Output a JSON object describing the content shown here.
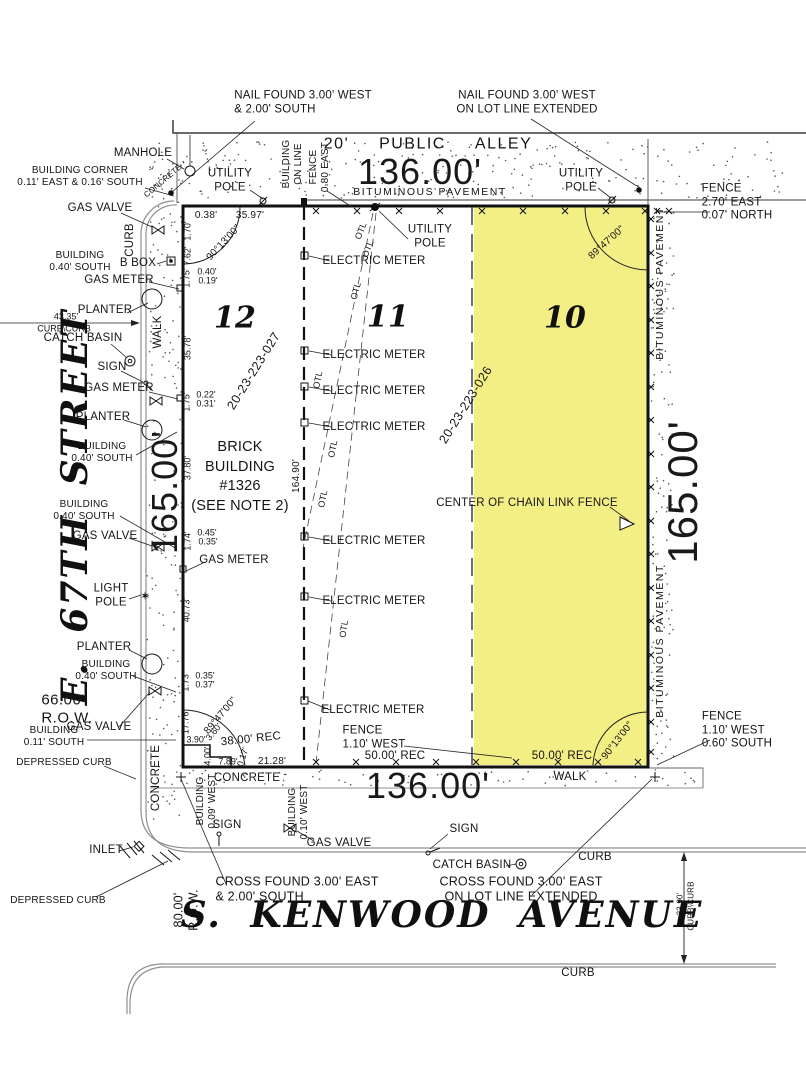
{
  "drawing_type": "plat-of-survey",
  "colors": {
    "highlight": "#f2ee7b",
    "linework": "#1c1c1c",
    "curb": "#8f8f8f"
  },
  "lots": [
    {
      "number": "12",
      "pin": "20-23-223-027"
    },
    {
      "number": "11",
      "pin": "20-23-223-026"
    },
    {
      "number": "10",
      "highlighted": true
    }
  ],
  "labels": [
    {
      "name": "nail-found-nw",
      "text": "NAIL FOUND 3.00' WEST\n& 2.00' SOUTH",
      "x": 303,
      "y": 103,
      "rot": 0,
      "cls": "t12 al"
    },
    {
      "name": "nail-found-ne",
      "text": "NAIL FOUND 3.00' WEST\nON LOT LINE EXTENDED",
      "x": 527,
      "y": 103,
      "rot": 0,
      "cls": "t12"
    },
    {
      "name": "manhole-label",
      "text": "MANHOLE",
      "x": 143,
      "y": 154,
      "rot": 0,
      "cls": "t12"
    },
    {
      "name": "building-corner-label",
      "text": "BUILDING CORNER\n0.11' EAST & 0.16' SOUTH",
      "x": 80,
      "y": 177,
      "rot": 0,
      "cls": "t10"
    },
    {
      "name": "concrete-corner-label",
      "text": "CONCRETE",
      "x": 163,
      "y": 181,
      "rot": -40,
      "cls": "t8"
    },
    {
      "name": "utility-pole-label-1",
      "text": "UTILITY\nPOLE",
      "x": 230,
      "y": 181,
      "rot": 0,
      "cls": "t12"
    },
    {
      "name": "building-on-line-label",
      "text": "BUILDING\nON LINE",
      "x": 293,
      "y": 164,
      "rot": -90,
      "cls": "t10"
    },
    {
      "name": "fence-080-label",
      "text": "FENCE\n0.80 EAST",
      "x": 320,
      "y": 167,
      "rot": -90,
      "cls": "t10"
    },
    {
      "name": "alley-label",
      "text": "20' PUBLIC ALLEY",
      "x": 428,
      "y": 145,
      "rot": 0,
      "cls": "alley"
    },
    {
      "name": "dim-136-top",
      "text": "136.00'",
      "x": 420,
      "y": 172,
      "rot": 0,
      "cls": "big"
    },
    {
      "name": "bituminous-alley-label",
      "text": "BITUMINOUS PAVEMENT",
      "x": 430,
      "y": 192,
      "rot": 0,
      "cls": "bit"
    },
    {
      "name": "utility-pole-label-2",
      "text": "UTILITY\nPOLE",
      "x": 581,
      "y": 181,
      "rot": 0,
      "cls": "t12"
    },
    {
      "name": "fence-ne-label",
      "text": "FENCE\n2.70' EAST\n0.07' NORTH",
      "x": 737,
      "y": 203,
      "rot": 0,
      "cls": "t12 al"
    },
    {
      "name": "gas-valve-label-1",
      "text": "GAS VALVE",
      "x": 100,
      "y": 209,
      "rot": 0,
      "cls": "t12"
    },
    {
      "name": "curb-left-label",
      "text": "CURB",
      "x": 131,
      "y": 240,
      "rot": -90,
      "cls": "t12"
    },
    {
      "name": "building-040-label-1",
      "text": "BUILDING\n0.40' SOUTH",
      "x": 80,
      "y": 262,
      "rot": 0,
      "cls": "t10"
    },
    {
      "name": "bbox-label",
      "text": "B BOX",
      "x": 138,
      "y": 264,
      "rot": 0,
      "cls": "t12"
    },
    {
      "name": "gas-meter-label-1",
      "text": "GAS METER",
      "x": 119,
      "y": 281,
      "rot": 0,
      "cls": "t12"
    },
    {
      "name": "planter-label-1",
      "text": "PLANTER",
      "x": 105,
      "y": 311,
      "rot": 0,
      "cls": "t12"
    },
    {
      "name": "dim-4335",
      "text": "43.35'",
      "x": 66,
      "y": 317,
      "rot": 0,
      "cls": "t9"
    },
    {
      "name": "curbcurb-label-1",
      "text": "CURB\\CURB",
      "x": 64,
      "y": 329,
      "rot": 0,
      "cls": "t9"
    },
    {
      "name": "catch-basin-label-1",
      "text": "CATCH BASIN",
      "x": 83,
      "y": 339,
      "rot": 0,
      "cls": "t12"
    },
    {
      "name": "sign-label-1",
      "text": "SIGN",
      "x": 112,
      "y": 368,
      "rot": 0,
      "cls": "t12"
    },
    {
      "name": "gas-meter-label-2",
      "text": "GAS METER",
      "x": 119,
      "y": 389,
      "rot": 0,
      "cls": "t12"
    },
    {
      "name": "planter-label-2",
      "text": "PLANTER",
      "x": 103,
      "y": 418,
      "rot": 0,
      "cls": "t12"
    },
    {
      "name": "building-040-label-2",
      "text": "BUILDING\n0.40' SOUTH",
      "x": 102,
      "y": 453,
      "rot": 0,
      "cls": "t10"
    },
    {
      "name": "building-040-label-3",
      "text": "BUILDING\n0.40' SOUTH",
      "x": 84,
      "y": 511,
      "rot": 0,
      "cls": "t10"
    },
    {
      "name": "gas-valve-label-2",
      "text": "GAS VALVE",
      "x": 105,
      "y": 537,
      "rot": 0,
      "cls": "t12"
    },
    {
      "name": "gas-meter-label-3",
      "text": "GAS METER",
      "x": 234,
      "y": 561,
      "rot": 0,
      "cls": "t12"
    },
    {
      "name": "light-pole-label",
      "text": "LIGHT\nPOLE",
      "x": 111,
      "y": 596,
      "rot": 0,
      "cls": "t12"
    },
    {
      "name": "planter-label-3",
      "text": "PLANTER",
      "x": 104,
      "y": 648,
      "rot": 0,
      "cls": "t12"
    },
    {
      "name": "street-67th-label",
      "text": "E. 67TH STREET",
      "x": 75,
      "y": 507,
      "rot": -90,
      "cls": "street"
    },
    {
      "name": "building-040-label-4",
      "text": "BUILDING\n0.40' SOUTH",
      "x": 106,
      "y": 671,
      "rot": 0,
      "cls": "t10"
    },
    {
      "name": "row-66-label",
      "text": "66.00'\nR.O.W.",
      "x": 67,
      "y": 709,
      "rot": 0,
      "cls": "t15 al"
    },
    {
      "name": "gas-valve-label-3",
      "text": "GAS VALVE",
      "x": 99,
      "y": 728,
      "rot": 0,
      "cls": "t12"
    },
    {
      "name": "building-011-label",
      "text": "BUILDING\n0.11' SOUTH",
      "x": 54,
      "y": 737,
      "rot": 0,
      "cls": "t10"
    },
    {
      "name": "depressed-curb-label-1",
      "text": "DEPRESSED CURB",
      "x": 64,
      "y": 763,
      "rot": 0,
      "cls": "t10"
    },
    {
      "name": "concrete-left-label",
      "text": "CONCRETE",
      "x": 157,
      "y": 778,
      "rot": -90,
      "cls": "t12"
    },
    {
      "name": "inlet-label",
      "text": "INLET",
      "x": 106,
      "y": 851,
      "rot": 0,
      "cls": "t12"
    },
    {
      "name": "depressed-curb-label-2",
      "text": "DEPRESSED CURB",
      "x": 58,
      "y": 901,
      "rot": 0,
      "cls": "t10"
    },
    {
      "name": "row-80-label",
      "text": "80.00'\nR.O.W.",
      "x": 186,
      "y": 910,
      "rot": -90,
      "cls": "t13"
    },
    {
      "name": "dim-038",
      "text": "0.38'",
      "x": 206,
      "y": 216,
      "rot": 0,
      "cls": "t10"
    },
    {
      "name": "dim-3597",
      "text": "35.97'",
      "x": 250,
      "y": 216,
      "rot": 0,
      "cls": "t10"
    },
    {
      "name": "dim-170",
      "text": "1.70'",
      "x": 188,
      "y": 231,
      "rot": -90,
      "cls": "t9"
    },
    {
      "name": "dim-762",
      "text": "7.62'",
      "x": 188,
      "y": 256,
      "rot": -90,
      "cls": "t9"
    },
    {
      "name": "angle-nw",
      "text": "90°13'00\"",
      "x": 224,
      "y": 243,
      "rot": -47,
      "cls": "t10"
    },
    {
      "name": "dim-175-a",
      "text": "1.75'",
      "x": 187,
      "y": 278,
      "rot": -90,
      "cls": "t9"
    },
    {
      "name": "dim-040",
      "text": "0.40'",
      "x": 207,
      "y": 272,
      "rot": 0,
      "cls": "t9"
    },
    {
      "name": "dim-019",
      "text": "0.19'",
      "x": 208,
      "y": 281,
      "rot": 0,
      "cls": "t9"
    },
    {
      "name": "dim-3578",
      "text": "35.78'",
      "x": 188,
      "y": 348,
      "rot": -90,
      "cls": "t9"
    },
    {
      "name": "dim-175-b",
      "text": "1.75'",
      "x": 187,
      "y": 402,
      "rot": -90,
      "cls": "t9"
    },
    {
      "name": "dim-022",
      "text": "0.22'",
      "x": 206,
      "y": 395,
      "rot": 0,
      "cls": "t9"
    },
    {
      "name": "dim-031",
      "text": "0.31'",
      "x": 206,
      "y": 404,
      "rot": 0,
      "cls": "t9"
    },
    {
      "name": "dim-3780",
      "text": "37.80'",
      "x": 188,
      "y": 468,
      "rot": -90,
      "cls": "t9"
    },
    {
      "name": "dim-174",
      "text": "1.74'",
      "x": 188,
      "y": 541,
      "rot": -90,
      "cls": "t9"
    },
    {
      "name": "dim-045",
      "text": "0.45'",
      "x": 207,
      "y": 533,
      "rot": 0,
      "cls": "t9"
    },
    {
      "name": "dim-035-a",
      "text": "0.35'",
      "x": 208,
      "y": 542,
      "rot": 0,
      "cls": "t9"
    },
    {
      "name": "dim-4073",
      "text": "40.73'",
      "x": 187,
      "y": 610,
      "rot": -90,
      "cls": "t9"
    },
    {
      "name": "dim-173",
      "text": "1.73'",
      "x": 186,
      "y": 682,
      "rot": -90,
      "cls": "t9"
    },
    {
      "name": "dim-035-b",
      "text": "0.35'",
      "x": 205,
      "y": 676,
      "rot": 0,
      "cls": "t9"
    },
    {
      "name": "dim-037",
      "text": "0.37'",
      "x": 205,
      "y": 685,
      "rot": 0,
      "cls": "t9"
    },
    {
      "name": "dim-1776",
      "text": "17.76'",
      "x": 186,
      "y": 722,
      "rot": -90,
      "cls": "t9"
    },
    {
      "name": "angle-sw",
      "text": "89°47'00\"",
      "x": 221,
      "y": 716,
      "rot": -50,
      "cls": "t10"
    },
    {
      "name": "dim-390",
      "text": "3.90'",
      "x": 196,
      "y": 740,
      "rot": 0,
      "cls": "t9"
    },
    {
      "name": "dim-360",
      "text": "3.60'",
      "x": 214,
      "y": 732,
      "rot": -50,
      "cls": "t9"
    },
    {
      "name": "rec-38",
      "text": "38.00' REC",
      "x": 251,
      "y": 740,
      "rot": -6,
      "cls": "t12"
    },
    {
      "name": "dim-400",
      "text": "4.00'",
      "x": 208,
      "y": 756,
      "rot": -90,
      "cls": "t9"
    },
    {
      "name": "dim-789",
      "text": "7.89'",
      "x": 228,
      "y": 762,
      "rot": 0,
      "cls": "t9"
    },
    {
      "name": "dim-017",
      "text": "0.17'",
      "x": 243,
      "y": 757,
      "rot": -72,
      "cls": "t9"
    },
    {
      "name": "dim-2128",
      "text": "21.28'",
      "x": 272,
      "y": 762,
      "rot": 0,
      "cls": "t10"
    },
    {
      "name": "dim-165-left",
      "text": "165.00'",
      "x": 165,
      "y": 492,
      "rot": -90,
      "cls": "big"
    },
    {
      "name": "lot-12-number",
      "text": "12",
      "x": 235,
      "y": 318,
      "rot": 0,
      "cls": "lot"
    },
    {
      "name": "pin-027",
      "text": "20-23-223-027",
      "x": 254,
      "y": 371,
      "rot": -58,
      "cls": "pin"
    },
    {
      "name": "brick-building-label",
      "text": "BRICK\nBUILDING\n#1326\n(SEE NOTE 2)",
      "x": 240,
      "y": 477,
      "rot": 0,
      "cls": "note"
    },
    {
      "name": "dim-16490",
      "text": "164.90'",
      "x": 297,
      "y": 476,
      "rot": -90,
      "cls": "t10"
    },
    {
      "name": "lot-11-number",
      "text": "11",
      "x": 388,
      "y": 317,
      "rot": 0,
      "cls": "lot"
    },
    {
      "name": "utility-pole-label-3",
      "text": "UTILITY\nPOLE",
      "x": 430,
      "y": 237,
      "rot": 0,
      "cls": "t12"
    },
    {
      "name": "electric-meter-label-1",
      "text": "ELECTRIC METER",
      "x": 374,
      "y": 262,
      "rot": 0,
      "cls": "t12"
    },
    {
      "name": "electric-meter-label-2",
      "text": "ELECTRIC METER",
      "x": 374,
      "y": 356,
      "rot": 0,
      "cls": "t12"
    },
    {
      "name": "electric-meter-label-3",
      "text": "ELECTRIC METER",
      "x": 374,
      "y": 392,
      "rot": 0,
      "cls": "t12"
    },
    {
      "name": "electric-meter-label-4",
      "text": "ELECTRIC METER",
      "x": 374,
      "y": 428,
      "rot": 0,
      "cls": "t12"
    },
    {
      "name": "electric-meter-label-5",
      "text": "ELECTRIC METER",
      "x": 374,
      "y": 542,
      "rot": 0,
      "cls": "t12"
    },
    {
      "name": "electric-meter-label-6",
      "text": "ELECTRIC METER",
      "x": 374,
      "y": 602,
      "rot": 0,
      "cls": "t12"
    },
    {
      "name": "electric-meter-label-7",
      "text": "ELECTRIC METER",
      "x": 373,
      "y": 711,
      "rot": 0,
      "cls": "t12"
    },
    {
      "name": "otl-label-1",
      "text": "OTL",
      "x": 361,
      "y": 231,
      "rot": -68,
      "cls": "t9"
    },
    {
      "name": "otl-label-2",
      "text": "OTL",
      "x": 368,
      "y": 249,
      "rot": -68,
      "cls": "t9"
    },
    {
      "name": "otl-label-3",
      "text": "OTL",
      "x": 356,
      "y": 291,
      "rot": -75,
      "cls": "t9"
    },
    {
      "name": "otl-label-4",
      "text": "OTL",
      "x": 318,
      "y": 380,
      "rot": -78,
      "cls": "t9"
    },
    {
      "name": "otl-label-5",
      "text": "OTL",
      "x": 333,
      "y": 449,
      "rot": -78,
      "cls": "t9"
    },
    {
      "name": "otl-label-6",
      "text": "OTL",
      "x": 323,
      "y": 499,
      "rot": -78,
      "cls": "t9"
    },
    {
      "name": "otl-label-7",
      "text": "OTL",
      "x": 344,
      "y": 629,
      "rot": -82,
      "cls": "t9"
    },
    {
      "name": "pin-026",
      "text": "20-23-223-026",
      "x": 466,
      "y": 405,
      "rot": -58,
      "cls": "pin"
    },
    {
      "name": "lot-10-number",
      "text": "10",
      "x": 565,
      "y": 318,
      "rot": 0,
      "cls": "lot"
    },
    {
      "name": "chain-link-fence-label",
      "text": "CENTER OF CHAIN LINK FENCE",
      "x": 527,
      "y": 504,
      "rot": 0,
      "cls": "t12"
    },
    {
      "name": "dim-165-right",
      "text": "165.00'",
      "x": 683,
      "y": 492,
      "rot": -90,
      "cls": "big2"
    },
    {
      "name": "bituminous-right-label-1",
      "text": "BITUMINOUS PAVEMENT",
      "x": 660,
      "y": 283,
      "rot": -90,
      "cls": "bit"
    },
    {
      "name": "bituminous-right-label-2",
      "text": "BITUMINOUS PAVEMENT",
      "x": 660,
      "y": 641,
      "rot": -90,
      "cls": "bit"
    },
    {
      "name": "angle-ne",
      "text": "89°47'00\"",
      "x": 607,
      "y": 243,
      "rot": -42,
      "cls": "t10"
    },
    {
      "name": "angle-se",
      "text": "90°13'00\"",
      "x": 618,
      "y": 741,
      "rot": -52,
      "cls": "t10"
    },
    {
      "name": "fence-sw-label",
      "text": "FENCE\n1.10' WEST",
      "x": 374,
      "y": 738,
      "rot": 0,
      "cls": "t12 al"
    },
    {
      "name": "rec-50-mid",
      "text": "50.00' REC",
      "x": 395,
      "y": 757,
      "rot": 0,
      "cls": "t12"
    },
    {
      "name": "rec-50-right",
      "text": "50.00' REC",
      "x": 562,
      "y": 757,
      "rot": 0,
      "cls": "t12"
    },
    {
      "name": "fence-se-label",
      "text": "FENCE\n1.10' WEST\n0.60' SOUTH",
      "x": 737,
      "y": 731,
      "rot": 0,
      "cls": "t12 al"
    },
    {
      "name": "dim-136-bottom",
      "text": "136.00'",
      "x": 428,
      "y": 786,
      "rot": 0,
      "cls": "big"
    },
    {
      "name": "concrete-bottom-label",
      "text": "CONCRETE",
      "x": 247,
      "y": 779,
      "rot": 0,
      "cls": "t12"
    },
    {
      "name": "walk-bottom-label",
      "text": "WALK",
      "x": 570,
      "y": 778,
      "rot": 0,
      "cls": "t12"
    },
    {
      "name": "walk-left-label",
      "text": "WALK",
      "x": 159,
      "y": 332,
      "rot": -90,
      "cls": "t12"
    },
    {
      "name": "building-009-label",
      "text": "BUILDING\n0.09' WEST",
      "x": 207,
      "y": 801,
      "rot": -90,
      "cls": "t10"
    },
    {
      "name": "sign-label-2",
      "text": "SIGN",
      "x": 227,
      "y": 826,
      "rot": 0,
      "cls": "t12"
    },
    {
      "name": "building-010-label",
      "text": "BUILDING\n0.10' WEST",
      "x": 299,
      "y": 812,
      "rot": -90,
      "cls": "t10"
    },
    {
      "name": "gas-valve-label-4",
      "text": "GAS VALVE",
      "x": 339,
      "y": 844,
      "rot": 0,
      "cls": "t12"
    },
    {
      "name": "sign-label-3",
      "text": "SIGN",
      "x": 464,
      "y": 830,
      "rot": 0,
      "cls": "t12"
    },
    {
      "name": "catch-basin-label-2",
      "text": "CATCH BASIN",
      "x": 472,
      "y": 866,
      "rot": 0,
      "cls": "t12"
    },
    {
      "name": "curb-label-1",
      "text": "CURB",
      "x": 595,
      "y": 858,
      "rot": 0,
      "cls": "t12"
    },
    {
      "name": "cross-found-left-label",
      "text": "CROSS FOUND 3.00' EAST\n& 2.00' SOUTH",
      "x": 297,
      "y": 889,
      "rot": 0,
      "cls": "t13 al"
    },
    {
      "name": "cross-found-right-label",
      "text": "CROSS FOUND 3.00' EAST\nON LOT LINE EXTENDED",
      "x": 521,
      "y": 889,
      "rot": 0,
      "cls": "t13"
    },
    {
      "name": "street-kenwood-label",
      "text": "S. KENWOOD AVENUE",
      "x": 442,
      "y": 915,
      "rot": 0,
      "cls": "street"
    },
    {
      "name": "dim-3390",
      "text": "33.90'",
      "x": 680,
      "y": 904,
      "rot": -90,
      "cls": "t8"
    },
    {
      "name": "curbcurb-label-2",
      "text": "CURB\\CURB",
      "x": 691,
      "y": 906,
      "rot": -90,
      "cls": "t8"
    },
    {
      "name": "curb-label-2",
      "text": "CURB",
      "x": 578,
      "y": 974,
      "rot": 0,
      "cls": "t12"
    }
  ]
}
